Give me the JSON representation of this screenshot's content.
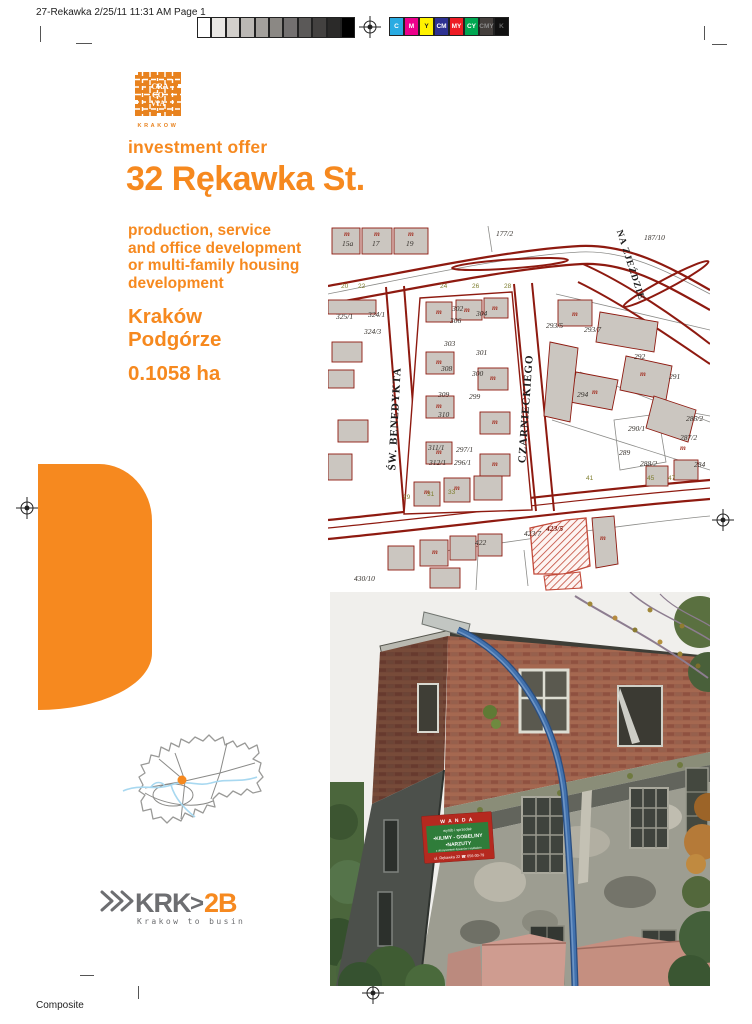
{
  "print": {
    "slug": "27-Rekawka 2/25/11 11:31 AM Page 1",
    "composite": "Composite",
    "grayscale": [
      "#ffffff",
      "#e9e7e4",
      "#d2cfcb",
      "#bbb8b4",
      "#a3a09c",
      "#8b8884",
      "#737070",
      "#5b5958",
      "#434140",
      "#2b2a29",
      "#000000"
    ],
    "color_bar": [
      {
        "label": "C",
        "color": "#29abe2"
      },
      {
        "label": "M",
        "color": "#ec008c"
      },
      {
        "label": "Y",
        "color": "#fff200"
      },
      {
        "label": "CM",
        "color": "#2e3192"
      },
      {
        "label": "MY",
        "color": "#ed1c24"
      },
      {
        "label": "CY",
        "color": "#00a651"
      },
      {
        "label": "CMY",
        "color": "#443f3c"
      },
      {
        "label": "K",
        "color": "#111111"
      }
    ]
  },
  "brand": {
    "cracovia": {
      "lines": [
        "CRA",
        "CO",
        "VIA"
      ],
      "sub": "KRAKOW"
    },
    "krk2b": {
      "krk": "KRK",
      "gt": ">",
      "b2": "2B",
      "tagline": "Krakow to business"
    }
  },
  "offer": {
    "kicker": "investment offer",
    "title": "32 Rękawka St.",
    "desc_lines": [
      "production, service",
      "and office development",
      "or multi-family housing",
      "development"
    ],
    "city": "Kraków",
    "district": "Podgórze",
    "area": "0.1058 ha"
  },
  "map": {
    "streets": {
      "benedykta": "ŚW. BENEDYKTA",
      "czarnieckiego": "CZARNIECKIEGO",
      "na_zjezdzie": "NA ZJEŹDZIE"
    },
    "building_symbol": "m",
    "highlight_parcel": "423/5",
    "parcels": [
      "15a",
      "17",
      "19",
      "177/2",
      "187/10",
      "325/1",
      "324/1",
      "324/3",
      "302",
      "304",
      "306",
      "303",
      "301",
      "308",
      "300",
      "309",
      "299",
      "310",
      "311/1",
      "297/1",
      "312/1",
      "296/1",
      "29",
      "31",
      "33",
      "293/5",
      "293/7",
      "292",
      "291",
      "294",
      "290/1",
      "289",
      "286/2",
      "287/2",
      "288/2",
      "284",
      "41",
      "45",
      "47",
      "422",
      "423/7",
      "423/5",
      "430/10"
    ],
    "addresses": [
      "20",
      "22",
      "24",
      "26",
      "28"
    ]
  },
  "photo": {
    "sign": {
      "header": "W A N D A",
      "line1": "wyrób i sprzedaż",
      "line2": "•KILIMY - GOBELINY",
      "line3": "•NARZUTY",
      "line4": "z obszywaniem dywanów i wykładzin",
      "footer": "ul. Rękawka 22  ☎ 656-00-79"
    }
  },
  "colors": {
    "accent_orange": "#f6891f",
    "logo_orange": "#e8821e",
    "map_red": "#8e1a10",
    "hatch_red": "#c24a3a"
  }
}
